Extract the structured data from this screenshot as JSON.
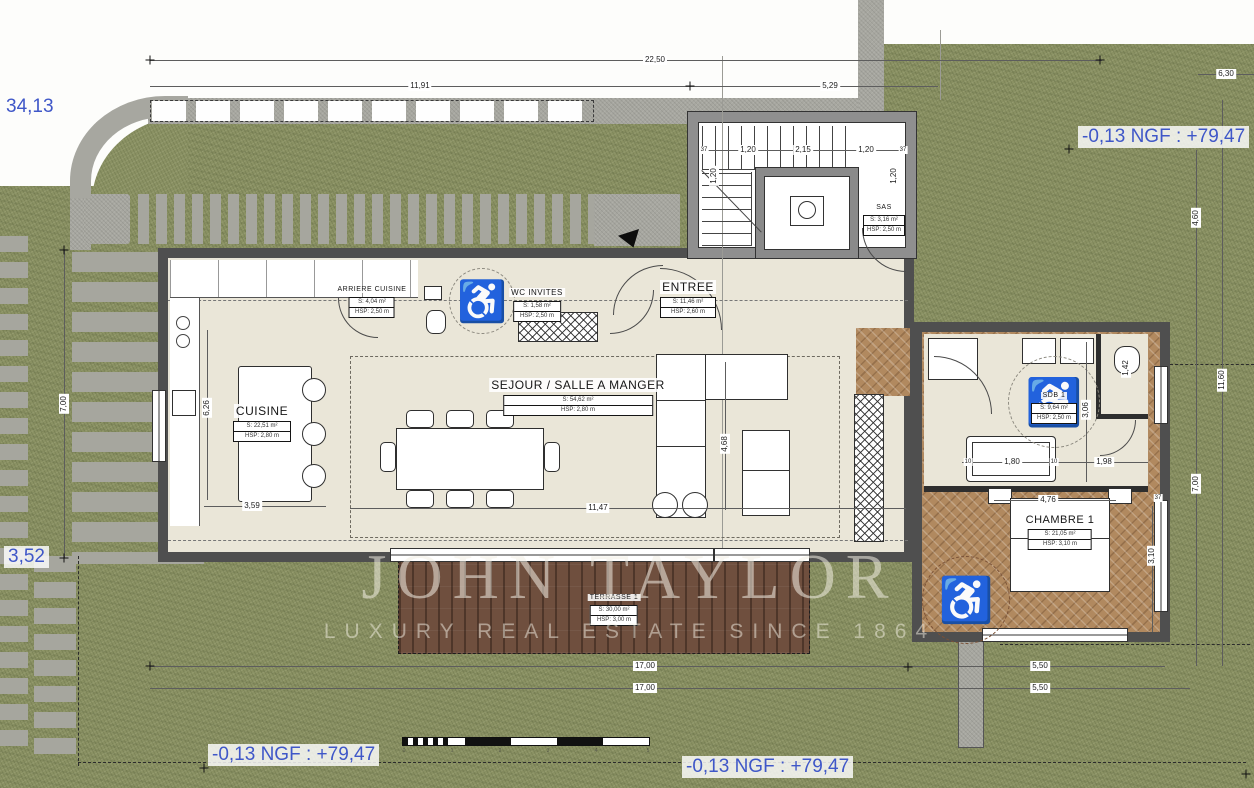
{
  "plan": {
    "levels": {
      "curve_elevation": "34,13",
      "left_elevation": "3,52",
      "ngf_top_right": "-0,13 NGF : +79,47",
      "ngf_bottom_left": "-0,13 NGF : +79,47",
      "ngf_bottom_center": "-0,13 NGF : +79,47"
    },
    "watermark": {
      "brand": "JOHN TAYLOR",
      "tagline": "LUXURY REAL ESTATE SINCE 1864"
    },
    "rooms": {
      "cuisine": {
        "name": "CUISINE",
        "area": "S: 22,51 m²",
        "hsp": "HSP: 2,80 m"
      },
      "sejour": {
        "name": "SEJOUR / SALLE A MANGER",
        "area": "S: 54,62 m²",
        "hsp": "HSP: 2,80 m"
      },
      "arriere": {
        "name": "ARRIERE CUISINE",
        "area": "S: 4,04 m²",
        "hsp": "HSP: 2,50 m"
      },
      "wc_invites": {
        "name": "WC INVITES",
        "area": "S: 1,58 m²",
        "hsp": "HSP: 2,50 m"
      },
      "entree": {
        "name": "ENTREE",
        "area": "S: 11,46 m²",
        "hsp": "HSP: 2,60 m"
      },
      "sas": {
        "name": "SAS",
        "area": "S: 3,16 m²",
        "hsp": "HSP: 2,50 m"
      },
      "sdb1": {
        "name": "SDB 1",
        "area": "S: 9,64 m²",
        "hsp": "HSP: 2,50 m"
      },
      "chambre1": {
        "name": "CHAMBRE 1",
        "area": "S: 21,05 m²",
        "hsp": "HSP: 3,10 m"
      },
      "terrasse1": {
        "name": "TERRASSE 1",
        "area": "S: 30,00 m²",
        "hsp": "HSP: 3,00 m"
      }
    },
    "dims": {
      "top_total": "22,50",
      "top_left": "11,91",
      "top_right": "5,29",
      "top_far_right": "6,30",
      "stair_wall_left": "37",
      "stair_seg1": "1,20",
      "stair_seg2": "2,15",
      "stair_seg3": "1,20",
      "stair_wall_right": "37",
      "stair_side_left": "1,20",
      "stair_side_right": "1,20",
      "left_height": "7,00",
      "kitchen_depth": "6,26",
      "island_length": "3,59",
      "living_width": "11,47",
      "living_depth": "4,68",
      "bed_wall": "4,76",
      "offset_left": "10",
      "bathtub": "1,80",
      "offset_right": "10",
      "wc_width": "1,98",
      "bath_depth": "3,06",
      "bath_niche": "1,42",
      "bedroom_depth": "3,10",
      "wing_wall": "37",
      "bottom_total_1": "17,00",
      "bottom_right_1": "5,50",
      "bottom_total_2": "17,00",
      "bottom_right_2": "5,50",
      "right_upper": "4,60",
      "right_total": "11,60",
      "right_lower": "7,00"
    },
    "scalebar": {
      "t0": "0",
      "t1": "1",
      "t2": "2",
      "t3": "3",
      "t4": "4",
      "t5": "5"
    },
    "icons": {
      "wheelchair": "♿"
    },
    "colors": {
      "grass": "#8a9163",
      "concrete": "#a7a7a0",
      "floor": "#eae6d8",
      "parquet": "#b1895f",
      "deck": "#6f4f3e",
      "annotation_blue": "#3f57c8"
    }
  }
}
